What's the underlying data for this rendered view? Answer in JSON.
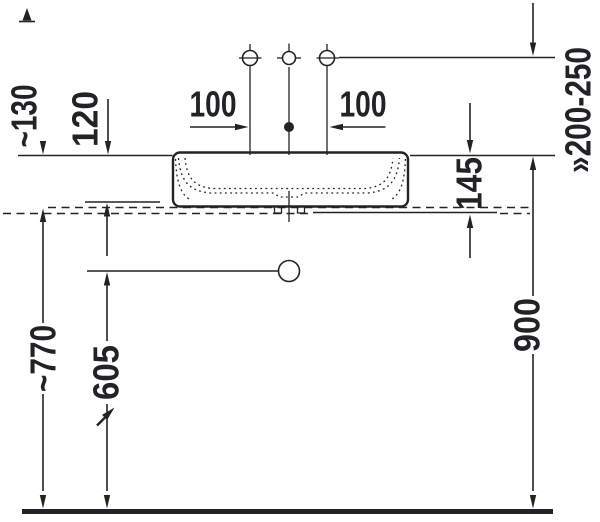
{
  "drawing": {
    "type": "washbasin installation side elevation",
    "colors": {
      "ink": "#232327",
      "background": "#ffffff"
    },
    "dimensions": {
      "wall_distance": "~130",
      "tap_offset": "120",
      "tap_hole_left": "100",
      "tap_hole_right": "100",
      "basin_rim_to_counter": "145",
      "tap_above_rim_range": "»200-250",
      "rim_height": "900",
      "outlet_height": "605",
      "counter_height": "~770"
    }
  }
}
